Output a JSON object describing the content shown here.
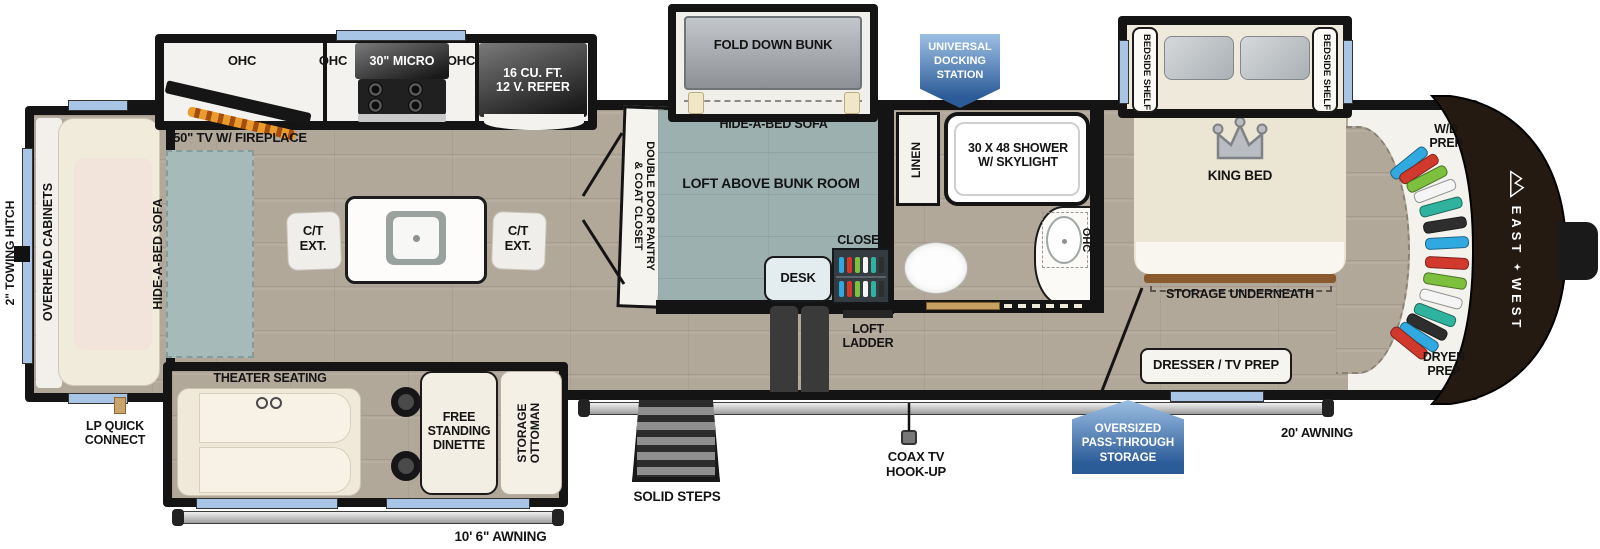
{
  "brand": {
    "east": "EAST",
    "west": "WEST"
  },
  "badges": {
    "docking": "UNIVERSAL\nDOCKING\nSTATION",
    "pass_through": "OVERSIZED\nPASS-THROUGH\nSTORAGE"
  },
  "exterior": {
    "towing_hitch": "2\" TOWING HITCH",
    "lp_quick_connect": "LP QUICK\nCONNECT",
    "awning_rear": "10' 6\" AWNING",
    "awning_main": "20' AWNING",
    "solid_steps": "SOLID STEPS",
    "coax": "COAX TV\nHOOK-UP"
  },
  "living": {
    "overhead_cabinets": "OVERHEAD CABINETS",
    "rear_sofa": "HIDE-A-BED SOFA",
    "tv_fireplace": "50\" TV W/ FIREPLACE",
    "ohc_left": "OHC",
    "ohc_mid": "OHC",
    "ohc_right": "OHC",
    "micro": "30\" MICRO",
    "refer": "16 CU. FT.\n12 V. REFER",
    "ct_ext_left": "C/T\nEXT.",
    "ct_ext_right": "C/T\nEXT.",
    "pantry": "DOUBLE DOOR PANTRY\n& COAT CLOSET",
    "theater": "THEATER SEATING",
    "dinette": "FREE\nSTANDING\nDINETTE",
    "ottoman": "STORAGE\nOTTOMAN"
  },
  "bunk_room": {
    "fold_down_bunk": "FOLD DOWN BUNK",
    "sofa": "HIDE-A-BED SOFA",
    "loft": "LOFT ABOVE BUNK ROOM",
    "desk": "DESK",
    "closet": "CLOSET",
    "loft_ladder": "LOFT\nLADDER"
  },
  "bathroom": {
    "linen": "LINEN",
    "shower": "30 X 48 SHOWER\nW/ SKYLIGHT",
    "ohc": "OHC"
  },
  "bedroom": {
    "bedside_shelf_left": "BEDSIDE SHELF",
    "bedside_shelf_right": "BEDSIDE SHELF",
    "king_bed": "KING BED",
    "storage_underneath": "STORAGE UNDERNEATH",
    "dresser": "DRESSER / TV PREP",
    "wd_prep": "W/D\nPREP",
    "dryer_prep": "DRYER\nPREP"
  },
  "closets": {
    "hanger_colors": [
      "#2fa9e0",
      "#d0392c",
      "#7cc03d",
      "#f5f5f5",
      "#2fb39e",
      "#2e2e2e"
    ]
  },
  "colors": {
    "floor": "#b2a89a",
    "bunk_floor": "#9bb0af",
    "rug": "#a6bbb9",
    "wall": "#141414",
    "window": "#a9c5e5",
    "badge_top": "#9dbfe3",
    "badge_bottom": "#2c5c98",
    "front_cap": "#241a12"
  }
}
